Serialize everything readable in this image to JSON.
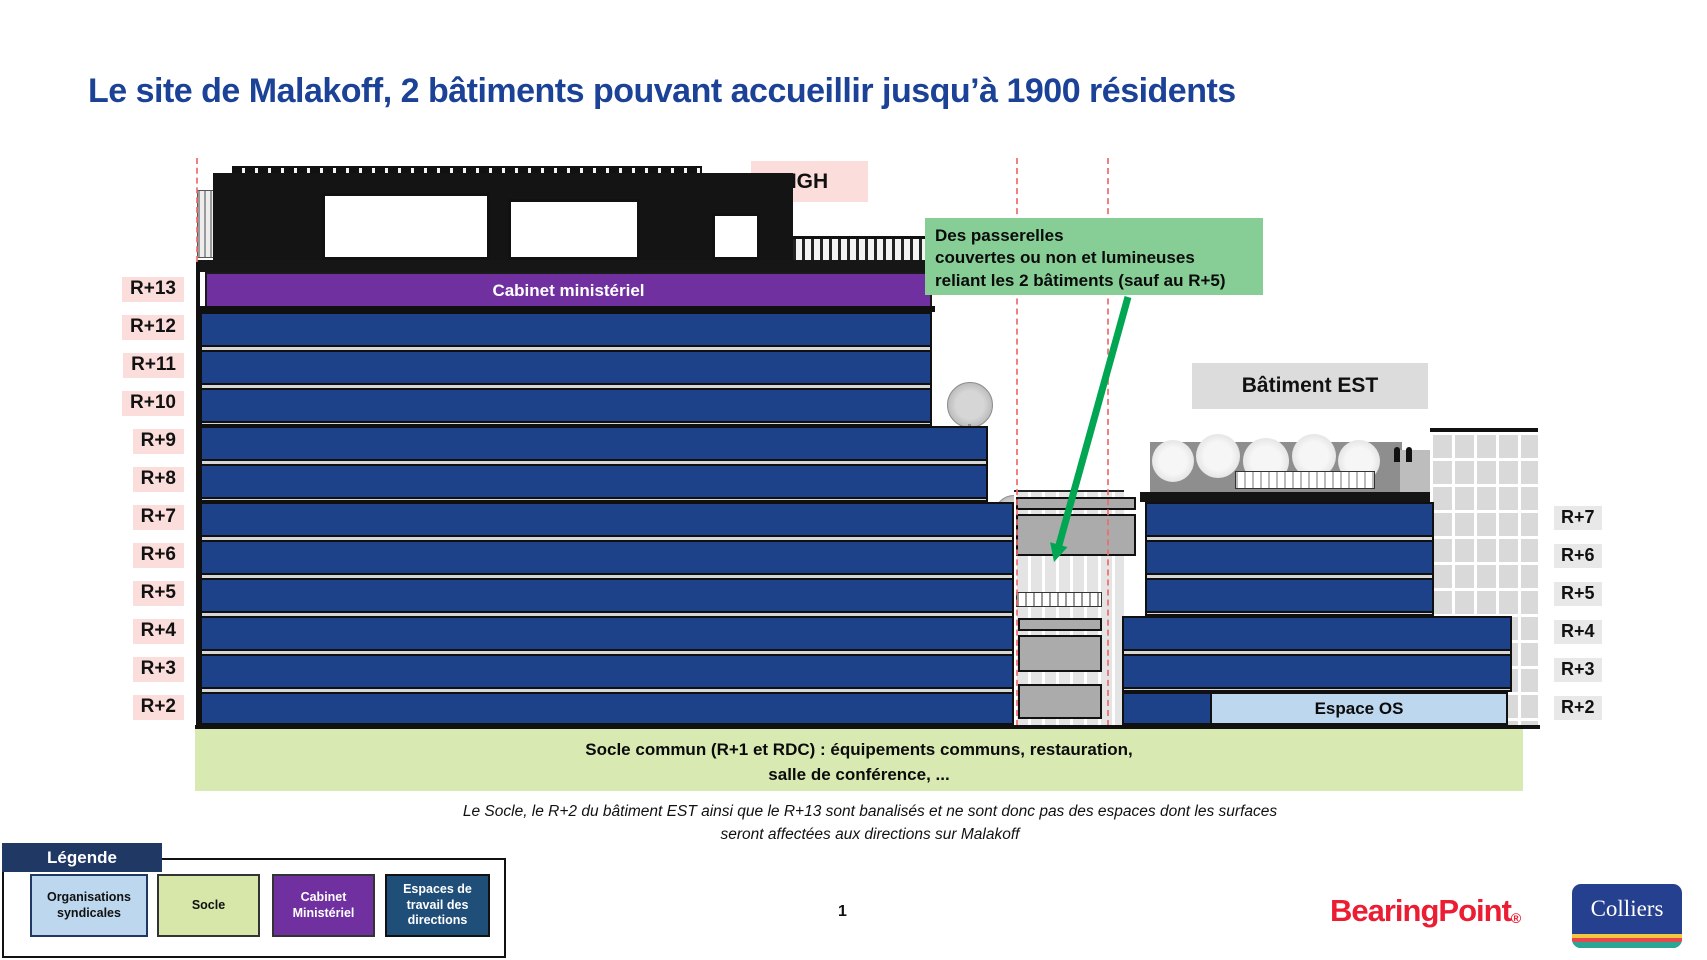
{
  "title": "Le site de Malakoff, 2 bâtiments pouvant accueillir jusqu’à 1900 résidents",
  "page_number": "1",
  "labels": {
    "igh": "IGH",
    "batiment_est": "Bâtiment EST",
    "cabinet_ministeriel": "Cabinet ministériel",
    "espace_os": "Espace OS"
  },
  "callout": {
    "line1": "Des passerelles",
    "line2": "couvertes ou non et lumineuses",
    "line3": "reliant les 2 bâtiments (sauf au R+5)"
  },
  "socle": {
    "line1": "Socle commun (R+1 et RDC) : équipements communs, restauration,",
    "line2": "salle de conférence, ..."
  },
  "footnote": {
    "line1": "Le Socle, le R+2 du bâtiment EST ainsi que le R+13 sont banalisés et ne sont donc pas des espaces dont les surfaces",
    "line2": "seront affectées aux directions sur Malakoff"
  },
  "floors": {
    "left": [
      "R+13",
      "R+12",
      "R+11",
      "R+10",
      "R+9",
      "R+8",
      "R+7",
      "R+6",
      "R+5",
      "R+4",
      "R+3",
      "R+2"
    ],
    "right": [
      "R+7",
      "R+6",
      "R+5",
      "R+4",
      "R+3",
      "R+2"
    ]
  },
  "legend": {
    "title": "Légende",
    "items": [
      {
        "label": "Organisations syndicales",
        "color": "#BDD7EE"
      },
      {
        "label": "Socle",
        "color": "#D6E7A9"
      },
      {
        "label": "Cabinet Ministériel",
        "color": "#7030A0"
      },
      {
        "label": "Espaces de travail des directions",
        "color": "#1F4E79"
      }
    ]
  },
  "logos": {
    "bearingpoint": "BearingPoint",
    "registered": "®",
    "colliers": "Colliers"
  },
  "colors": {
    "title_blue": "#1B4296",
    "floor_blue": "#1D4289",
    "cabinet_purple": "#7030A0",
    "label_pink": "#FBDEDB",
    "callout_green": "#86CD96",
    "arrow_green": "#00A651",
    "socle_green": "#D9E9B2",
    "espace_os_blue": "#BDD7EE",
    "legend_navy": "#1F3864",
    "legend_dark_blue": "#1F4E79",
    "bearingpoint_red": "#EC1C33",
    "colliers_blue": "#25408F"
  }
}
